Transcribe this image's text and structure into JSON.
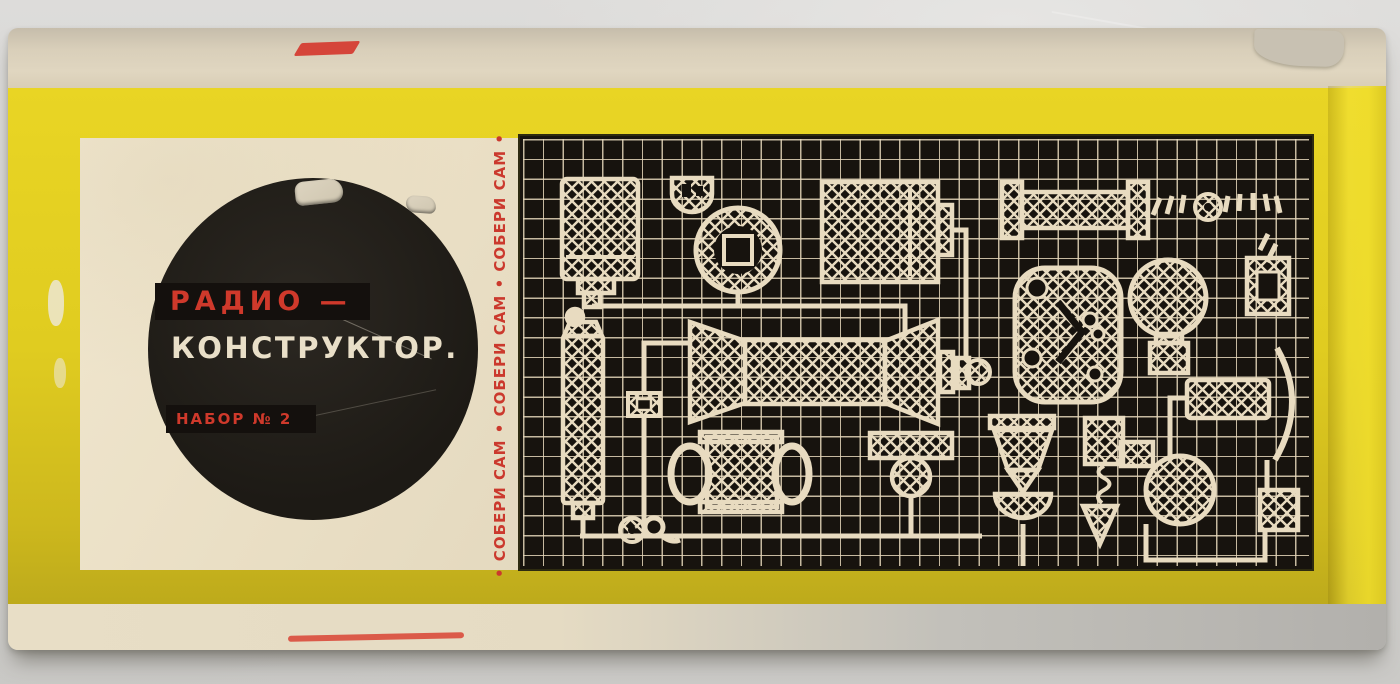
{
  "box_label": {
    "brand_line1": "РАДИО —",
    "brand_line2": "КОНСТРУКТОР.",
    "set_number": "НАБОР № 2",
    "side_slogan": "•  СОБЕРИ САМ   •   СОБЕРИ САМ   •   СОБЕРИ САМ  •"
  },
  "colors": {
    "box_yellow": "#e3ce20",
    "label_cream": "#ece1c8",
    "panel_black": "#17130e",
    "print_cream": "#e8dbc0",
    "accent_red": "#cf392b",
    "circle_black": "#211d18"
  },
  "panel_components": [
    "power-transformer",
    "round-cell-battery",
    "contact-cup",
    "tuning-capacitor",
    "flat-battery",
    "resistor",
    "screws-and-washer",
    "mounting-frame",
    "loudspeaker",
    "indicator-bulb",
    "coil-spool",
    "terminal-block",
    "output-transformer",
    "grommet",
    "pulley-bracket",
    "horn-earpiece",
    "screw-with-coil-tip",
    "earphone-capsule",
    "inductor-coil",
    "terminal-square",
    "wiring"
  ]
}
